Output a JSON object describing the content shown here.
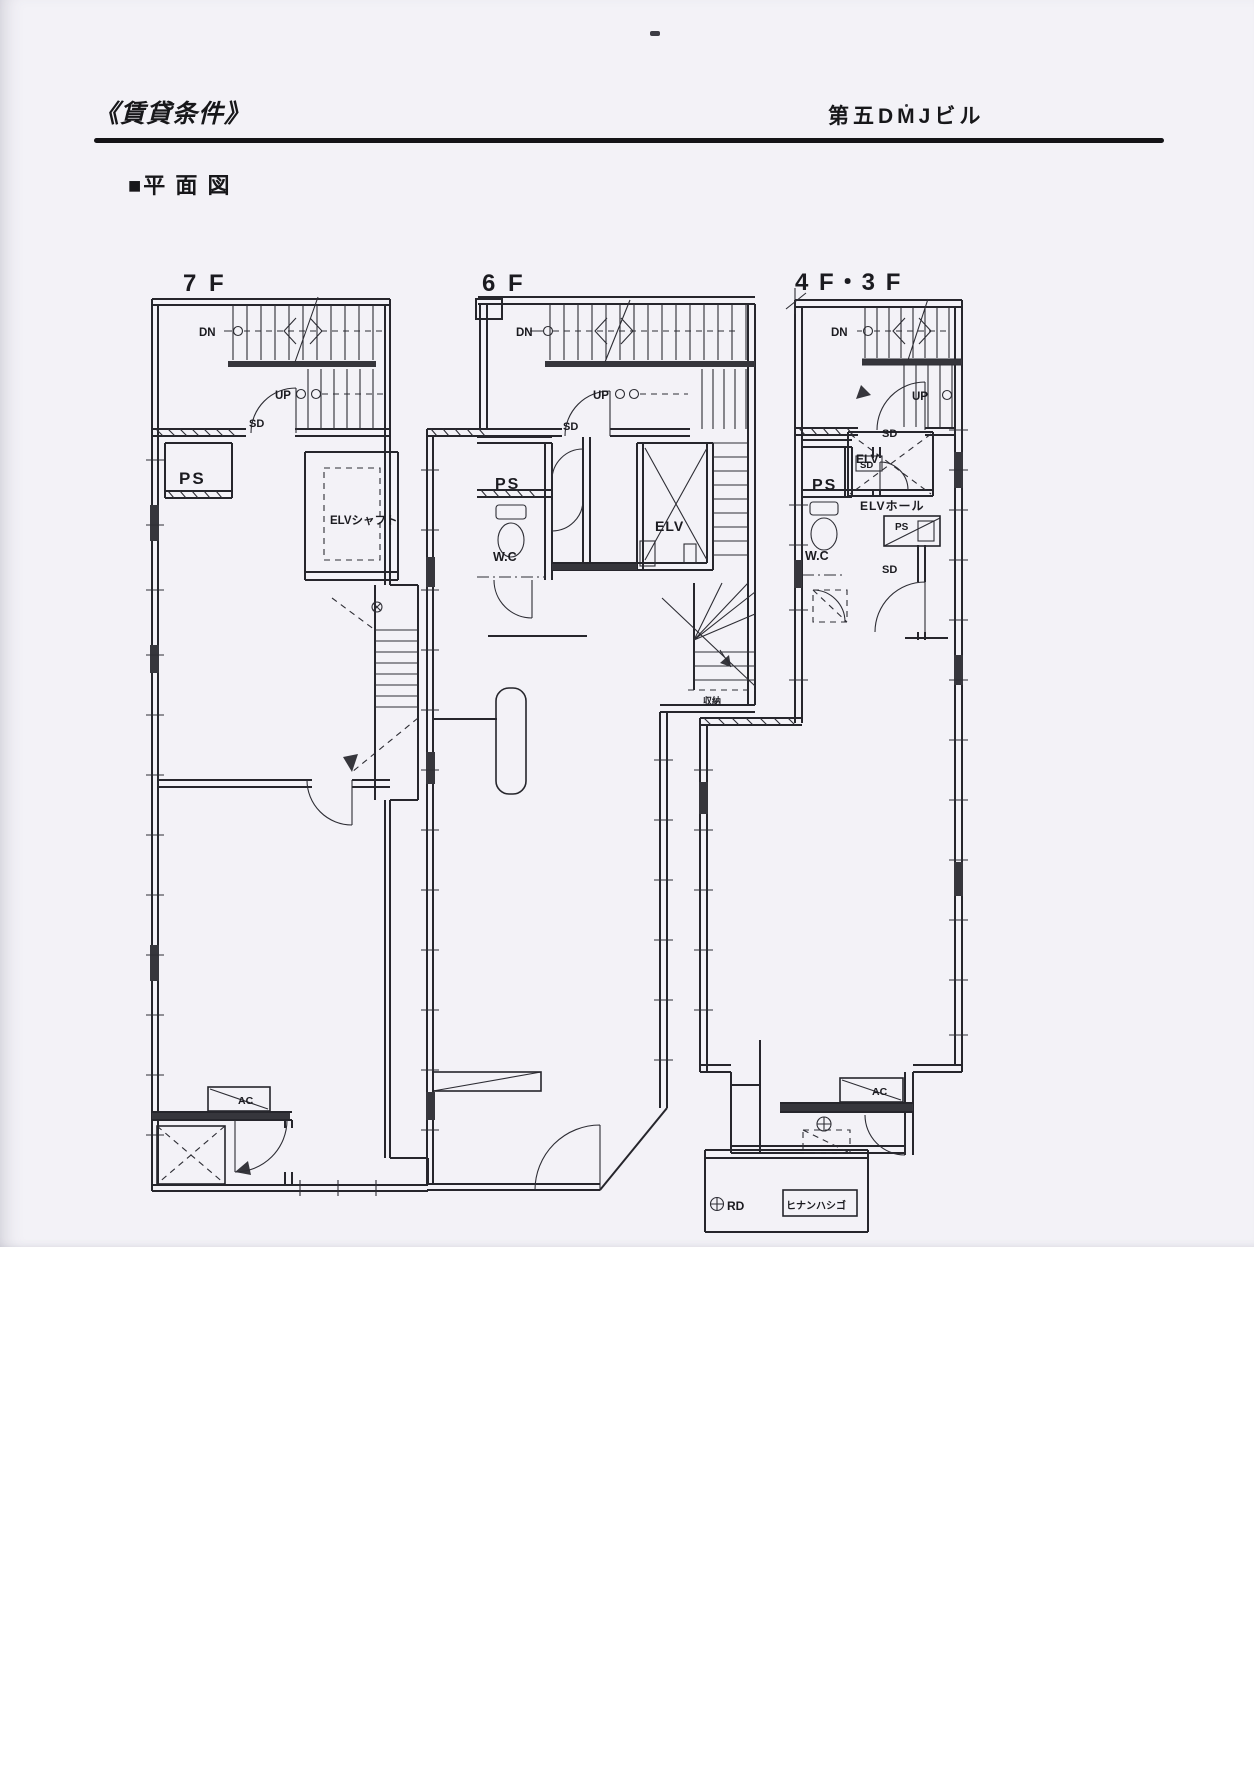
{
  "header": {
    "doc_title": "《賃貸条件》",
    "building_name": "第五DMJビル"
  },
  "section_title": "■平 面 図",
  "plans": {
    "f7": {
      "floor_label": "7 F",
      "dn": "DN",
      "up": "UP",
      "sd": "SD",
      "ps": "PS",
      "elv_shaft": "ELVシャフト",
      "ac": "AC"
    },
    "f6": {
      "floor_label": "6 F",
      "dn": "DN",
      "up": "UP",
      "sd": "SD",
      "ps": "PS",
      "wc": "W.C",
      "elv": "ELV",
      "storage": "収納"
    },
    "f43": {
      "floor_label": "4 F・3 F",
      "dn": "DN",
      "up": "UP",
      "sd_stair": "SD",
      "sd_ps": "SD",
      "sd_hall": "SD",
      "ps": "PS",
      "wc": "W.C",
      "elv": "ELV",
      "elv_hall": "ELVホール",
      "ps_right": "PS",
      "ac": "AC",
      "rd": "RD",
      "ladder": "ヒナンハシゴ"
    }
  }
}
